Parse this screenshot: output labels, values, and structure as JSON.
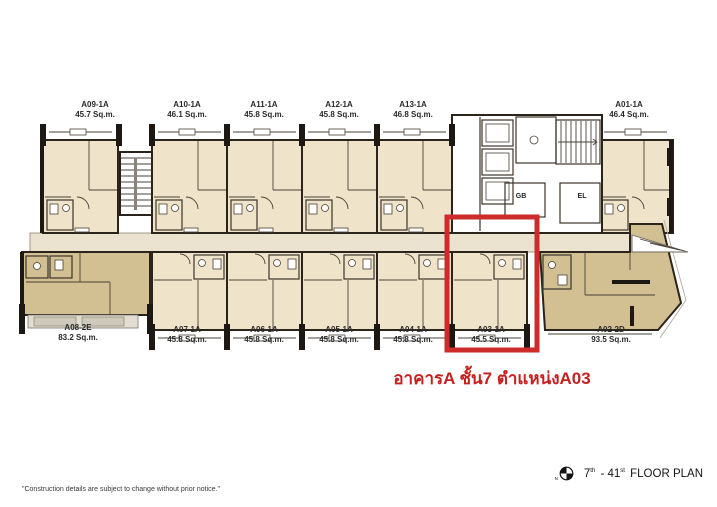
{
  "page": {
    "annotation": "อาคารA ชั้น7 ตำแหน่งA03",
    "disclaimer": "\"Construction details are subject to change without prior notice.\"",
    "plan_title": {
      "north_label": "N",
      "num1": "7",
      "sup1": "th",
      "num2": "- 41",
      "sup2": "st",
      "label": "FLOOR PLAN"
    }
  },
  "core": {
    "gb_label": "GB",
    "el_label": "EL"
  },
  "units": [
    {
      "name": "A09-1A",
      "area": "45.7 Sq.m."
    },
    {
      "name": "A10-1A",
      "area": "46.1 Sq.m."
    },
    {
      "name": "A11-1A",
      "area": "45.8 Sq.m."
    },
    {
      "name": "A12-1A",
      "area": "45.8 Sq.m."
    },
    {
      "name": "A13-1A",
      "area": "46.8 Sq.m."
    },
    {
      "name": "A01-1A",
      "area": "46.4 Sq.m."
    },
    {
      "name": "A08-2E",
      "area": "83.2 Sq.m."
    },
    {
      "name": "A07-1A",
      "area": "45.8 Sq.m."
    },
    {
      "name": "A06-1A",
      "area": "45.8 Sq.m."
    },
    {
      "name": "A05-1A",
      "area": "45.8 Sq.m."
    },
    {
      "name": "A04-1A",
      "area": "45.8 Sq.m."
    },
    {
      "name": "A03-1A",
      "area": "45.5 Sq.m.",
      "highlighted": true
    },
    {
      "name": "A02-2D",
      "area": "93.5 Sq.m."
    }
  ],
  "colors": {
    "highlight_box": "#ce2b2b",
    "annotation_text": "#c6211f",
    "unit_fill_light": "#efe4c9",
    "unit_fill_dark": "#d2bf92",
    "wall": "#2b241c"
  }
}
